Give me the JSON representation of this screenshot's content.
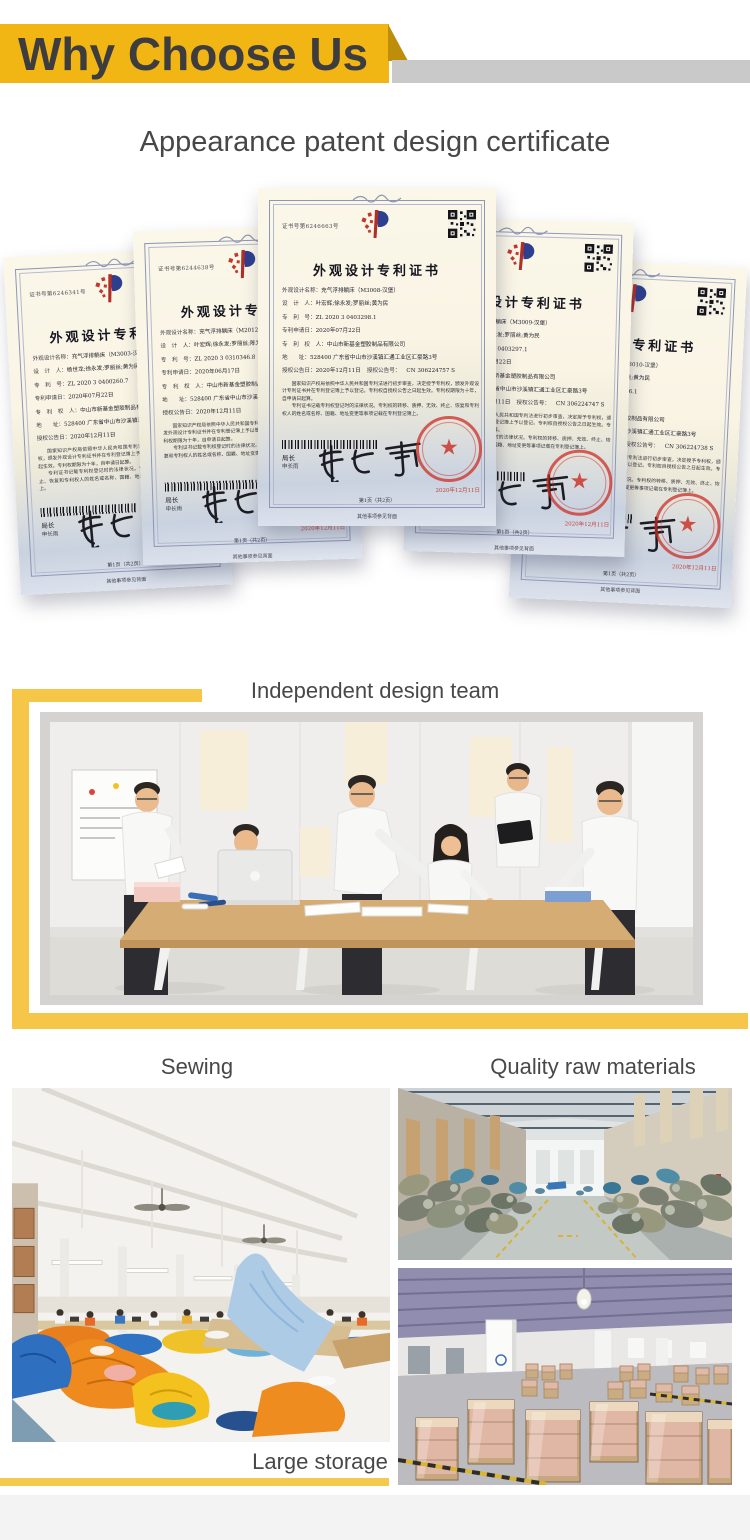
{
  "header": {
    "title": "Why Choose Us"
  },
  "colors": {
    "banner_yellow": "#F2B614",
    "fold_gold": "#BE8D09",
    "bar_gray": "#C9C9C9",
    "frame_yellow": "#F5C647",
    "underline_yellow": "#F5C94E",
    "heading_text": "#3D3D40",
    "label_text": "#48484A",
    "seal_red": "#CD2B20"
  },
  "certificate_section": {
    "heading": "Appearance patent design certificate",
    "common": {
      "title": "外观设计专利证书",
      "labels": [
        "外观设计名称：",
        "设　计　人：",
        "专　利　号：",
        "专利申请日：",
        "专　利　权　人：",
        "地　　址：",
        "授权公告日："
      ],
      "grant_no_label": "授权公告号：",
      "para1": "国家知识产权局依照中华人民共和国专利法进行初步审查，决定授予专利权，颁发外观设计专利证书并在专利登记簿上予以登记。专利权自授权公告之日起生效。专利权期限为十年，自申请日起算。",
      "para2": "专利证书记载专利权登记时的法律状况。专利权的转移、质押、无效、终止、恢复和专利权人的姓名或名称、国籍、地址变更等事项记载在专利登记簿上。",
      "director_label": "局长",
      "director_name": "申长雨",
      "signature": "申长雨",
      "seal_text": "国家知识产权局",
      "seal_date": "2020年12月11日",
      "page_note": "第1页（共2页）",
      "back_note": "其他事项参见背面"
    },
    "items": [
      {
        "cert_no": "证书号第6246341号",
        "design_name": "充气浮排躺床（M3003-汉堡）",
        "designers": "杨世龙;徐永发;罗丽丝;黄为民",
        "patent_no": "ZL 2020 3 0400260.7",
        "application_date": "2020年07月22日",
        "patentee": "中山市新基金塑胶制品有限公司",
        "address": "528400 广东省中山市沙溪镇汇通工业区汇豪路3号",
        "grant_date": "2020年12月11日",
        "grant_no": "",
        "has_qr": false
      },
      {
        "cert_no": "证书号第6244638号",
        "design_name": "充气浮排躺床（M2012-马戏团）",
        "designers": "叶宏辉;徐永发;罗丽丝;陈为民",
        "patent_no": "ZL 2020 3 0310346.8",
        "application_date": "2020年06月17日",
        "patentee": "中山市新基金塑胶制品有限公司",
        "address": "528400 广东省中山市沙溪镇汇通工业区汇豪路3号",
        "grant_date": "2020年12月11日",
        "grant_no": "",
        "has_qr": false
      },
      {
        "cert_no": "证书号第6246663号",
        "design_name": "充气浮排躺床（M3008-汉堡）",
        "designers": "叶宏辉;徐永发;罗丽丝;黄为民",
        "patent_no": "ZL 2020 3 0403298.1",
        "application_date": "2020年07月22日",
        "patentee": "中山市新基金塑胶制品有限公司",
        "address": "528400 广东省中山市沙溪镇汇通工业区汇豪路3号",
        "grant_date": "2020年12月11日",
        "grant_no": "CN 306224757 S",
        "has_qr": true
      },
      {
        "cert_no": "证书号第6246660号",
        "design_name": "充气浮排躺床（M3009-汉堡）",
        "designers": "叶宏辉;徐永发;罗丽丝;黄为民",
        "patent_no": "ZL 2020 3 0403297.1",
        "application_date": "2020年07月22日",
        "patentee": "中山市新基金塑胶制品有限公司",
        "address": "528400 广东省中山市沙溪镇汇通工业区汇豪路3号",
        "grant_date": "2020年12月11日",
        "grant_no": "CN 306224747 S",
        "has_qr": true
      },
      {
        "cert_no": "证书号第6246655号",
        "design_name": "充气浮排躺床（M3010-汉堡）",
        "designers": "叶宏辉;徐永发;罗丽丝;黄为民",
        "patent_no": "ZL 2020 3 0403296.1",
        "application_date": "2020年07月22日",
        "patentee": "中山市新基金塑胶制品有限公司",
        "address": "528400 广东省中山市沙溪镇汇通工业区汇豪路3号",
        "grant_date": "2020年12月11日",
        "grant_no": "CN 306224738 S",
        "has_qr": true
      }
    ]
  },
  "photos": {
    "team": {
      "label": "Independent design team"
    },
    "sewing": {
      "label": "Sewing"
    },
    "materials": {
      "label": "Quality raw materials"
    },
    "storage": {
      "label": "Large storage"
    }
  }
}
